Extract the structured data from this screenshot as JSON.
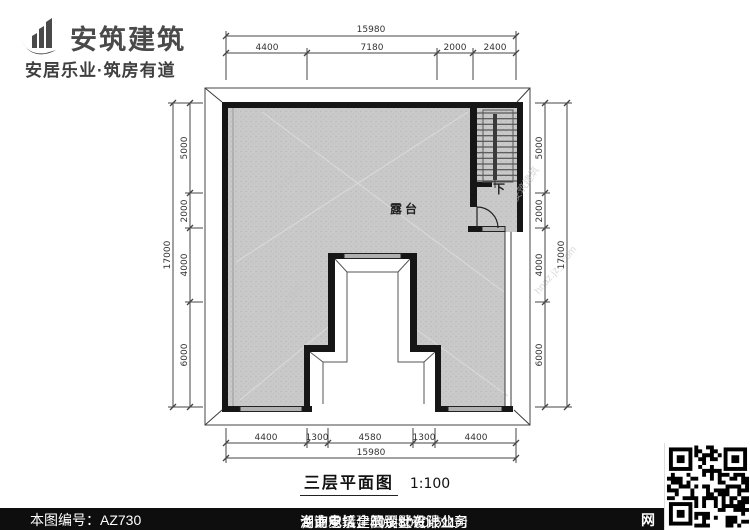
{
  "colors": {
    "wall": "#161616",
    "terrace_fill": "#c9c9c9",
    "line": "#3a3a3a",
    "logo": "#4a4a4a",
    "footer_bg": "#0e0e0e",
    "window_sill": "#b0b0b0"
  },
  "logo": {
    "name": "安筑建筑",
    "tagline": "安居乐业·筑房有道"
  },
  "plan": {
    "room_label": "露台",
    "stair_label": "下",
    "dims": {
      "top_total": "15980",
      "top": [
        "4400",
        "7180",
        "2000",
        "2400"
      ],
      "bottom": [
        "4400",
        "1300",
        "4580",
        "1300",
        "4400"
      ],
      "bottom_total": "15980",
      "left": [
        "5000",
        "2000",
        "4000",
        "6000"
      ],
      "left_total": "17000",
      "right": [
        "5000",
        "2000",
        "4000",
        "6000"
      ],
      "right_total": "17000"
    }
  },
  "title": {
    "text": "三层平面图",
    "scale": "1:100"
  },
  "watermark": {
    "site": "hnaz.jz_.com",
    "brand": "安筑建筑"
  },
  "footer": {
    "number": "本图编号：AZ730",
    "company": "湖南安筑建筑设计有限公司",
    "business": "专业承接全国别墅设计业务",
    "phone": "咨询电话：400-8070-511",
    "web": "网"
  }
}
